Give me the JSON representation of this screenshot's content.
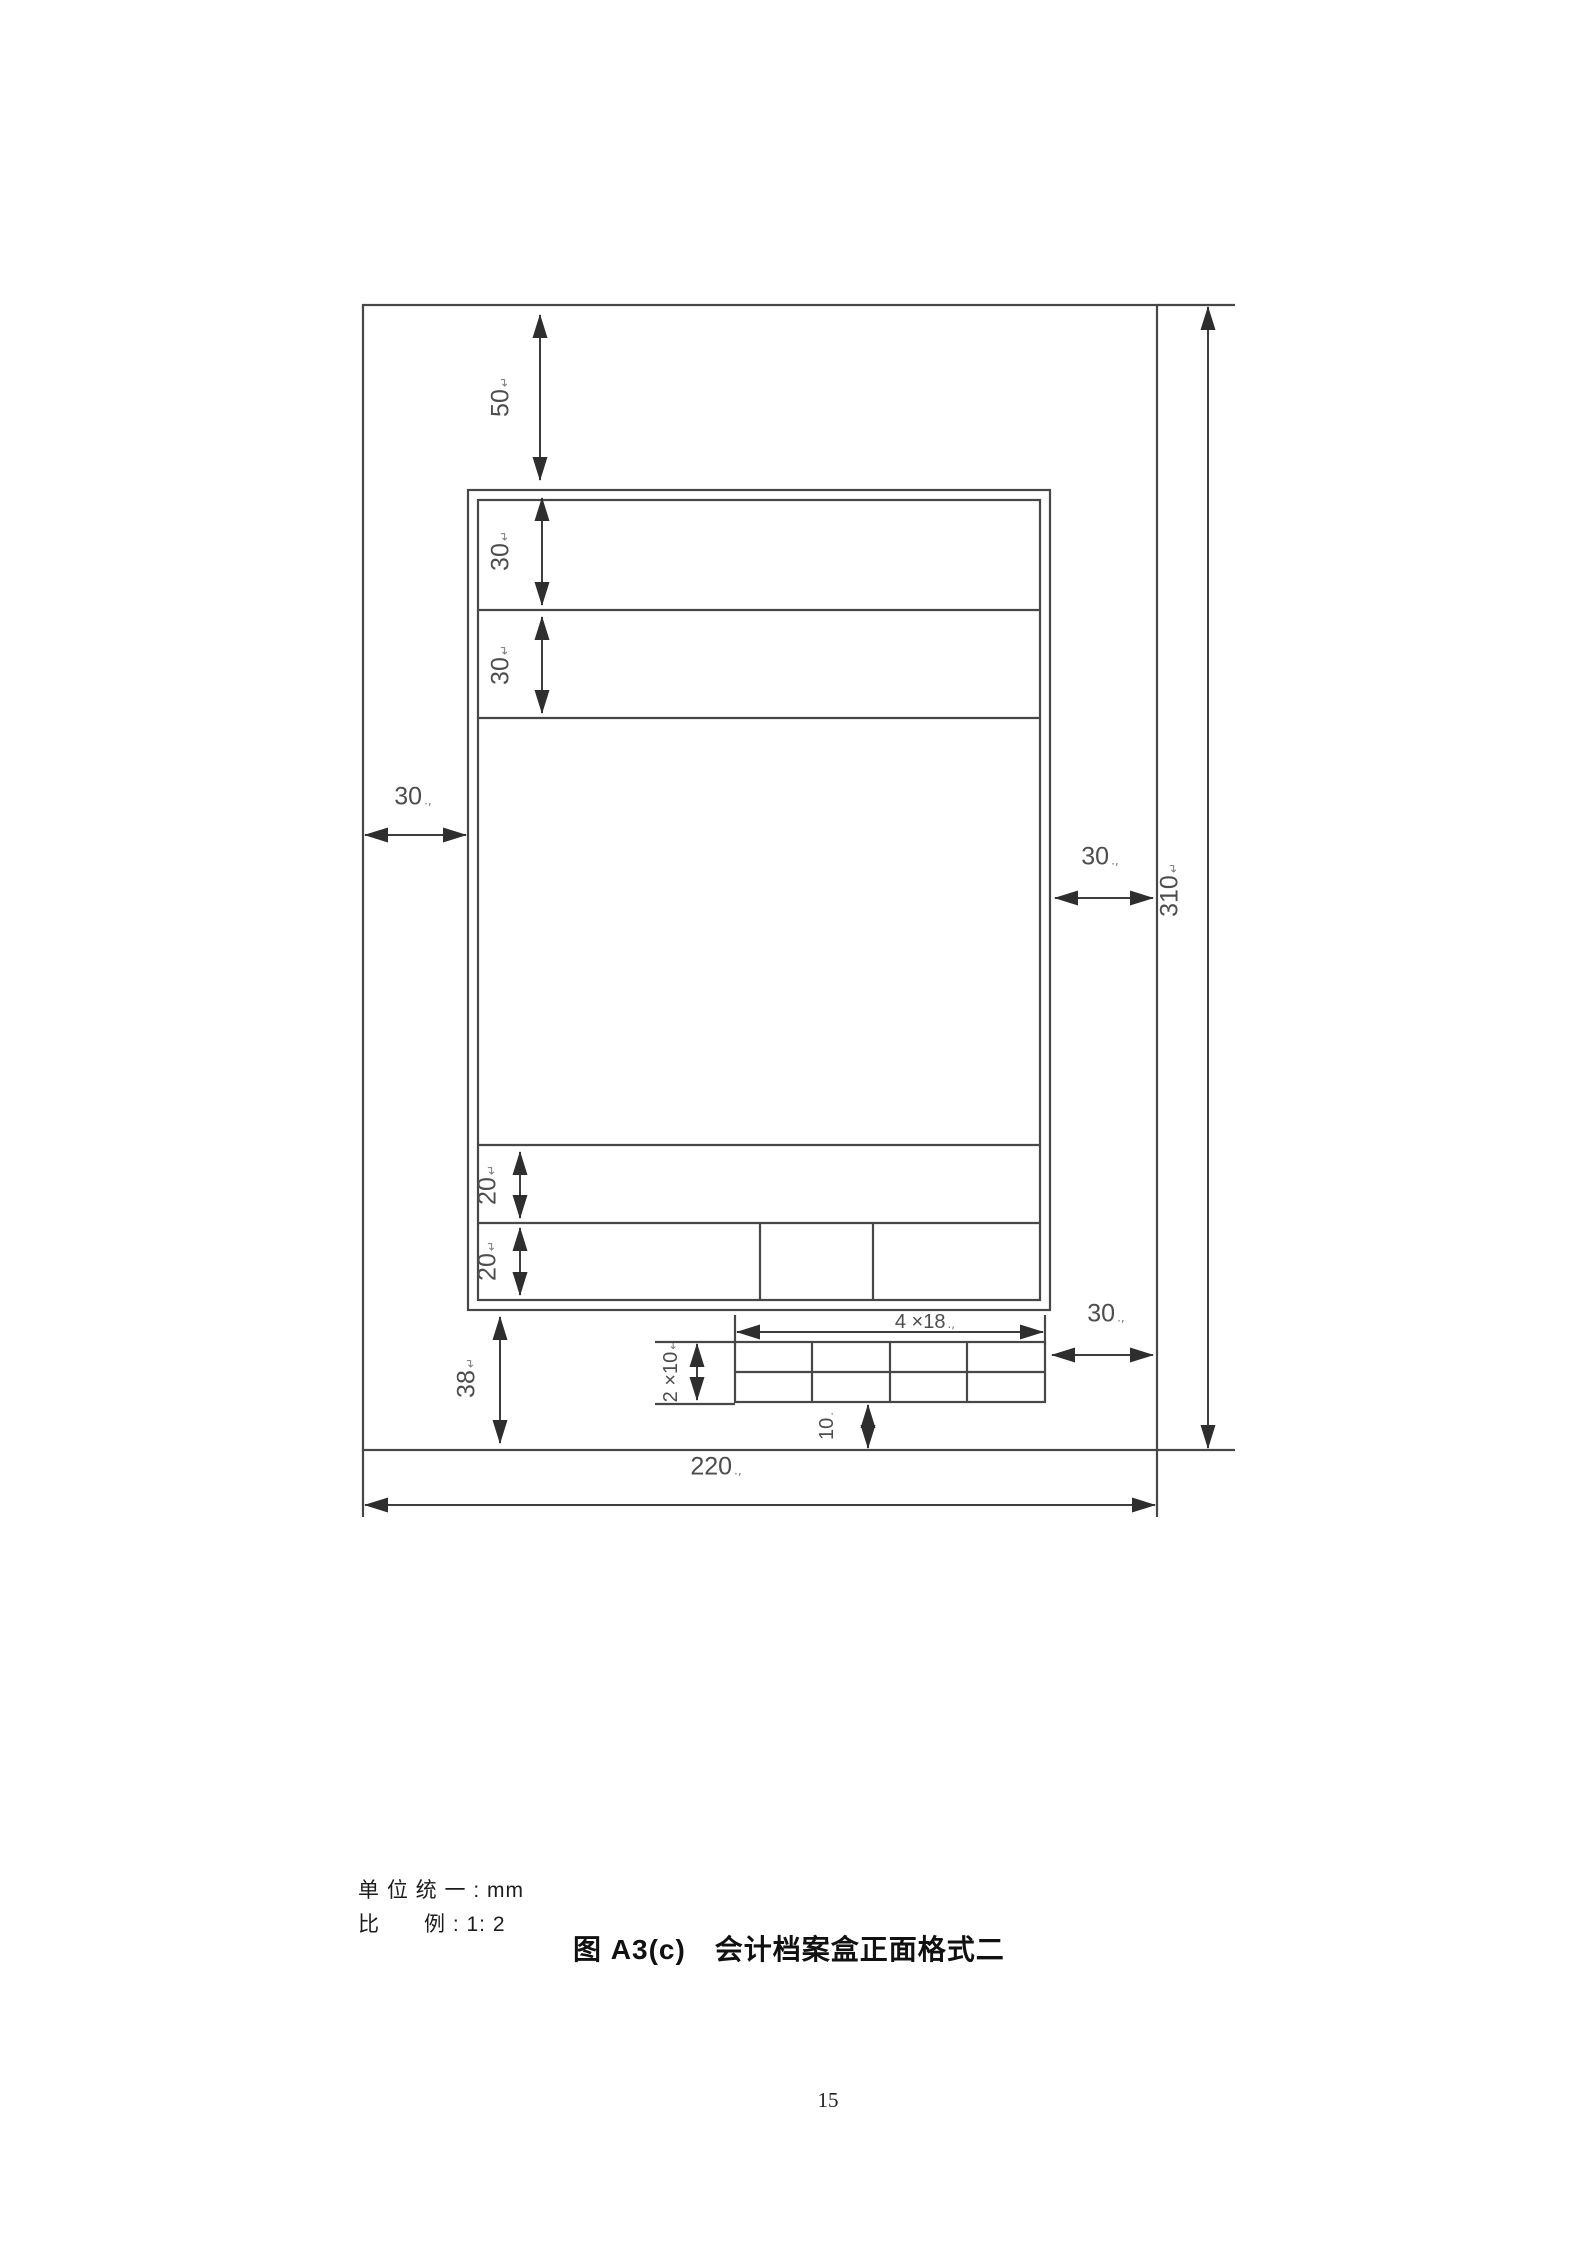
{
  "page": {
    "number": "15"
  },
  "notes": {
    "unit": "单 位 统 一 : mm",
    "scale": "比　　例 : 1: 2"
  },
  "caption": "图 A3(c)　会计档案盒正面格式二",
  "colors": {
    "line": "#474747",
    "dim_label": "#4d4d4d",
    "text": "#1c1c1c"
  },
  "dims": {
    "d50": {
      "value": "50",
      "suffix": "↵"
    },
    "d30_row1": {
      "value": "30",
      "suffix": "↵"
    },
    "d30_row2": {
      "value": "30",
      "suffix": "↵"
    },
    "d30_left": {
      "value": "30",
      "suffix": ".,"
    },
    "d30_right": {
      "value": "30",
      "suffix": ".,"
    },
    "d30_bottom": {
      "value": "30",
      "suffix": ".,"
    },
    "d310": {
      "value": "310",
      "suffix": "↵"
    },
    "d20_row1": {
      "value": "20",
      "suffix": "↵"
    },
    "d20_row2": {
      "value": "20",
      "suffix": "↵"
    },
    "d38": {
      "value": "38",
      "suffix": "↵"
    },
    "d4x18": {
      "value": "4 ×18",
      "suffix": ".,"
    },
    "d2x10": {
      "value": "2 ×10",
      "suffix": "↵"
    },
    "d10": {
      "value": "10",
      "suffix": "."
    },
    "d220": {
      "value": "220",
      "suffix": ".,"
    }
  }
}
